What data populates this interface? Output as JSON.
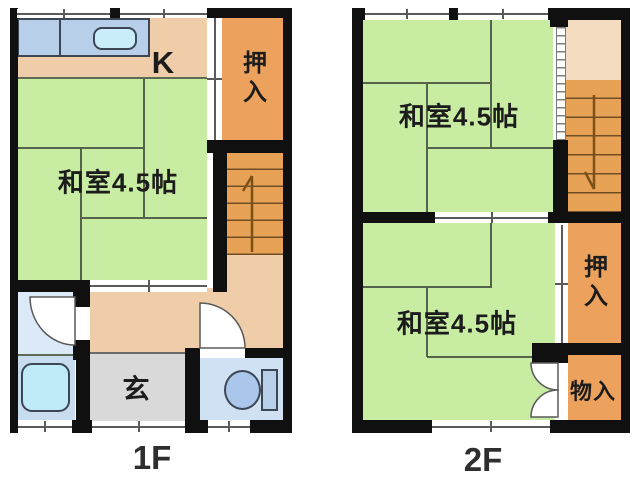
{
  "floor1": {
    "floor_label": "1F",
    "kitchen_label": "K",
    "tatami_room_label": "和室4.5帖",
    "closet_label": "押入",
    "entrance_label": "玄"
  },
  "floor2": {
    "floor_label": "2F",
    "tatami_room_top_label": "和室4.5帖",
    "tatami_room_bottom_label": "和室4.5帖",
    "closet_label": "押入",
    "storage_label": "物入"
  },
  "colors": {
    "wall": "#101010",
    "tatami_green": "#c7eca2",
    "floor_peach": "#f0cda9",
    "stair_landing": "#f4dcc0",
    "closet_orange": "#eca25d",
    "stairs_orange": "#e7a256",
    "genkan_gray": "#d9d9d9",
    "counter_blue": "#b7cfe9",
    "sink_blue": "#c9eefa",
    "washroom_blue": "#dce9f7",
    "bath_blue": "#c8dcf0",
    "tub_blue": "#bfeaf8",
    "toilet_blue": "#cfe1f2",
    "label_text": "#1c1c1c"
  }
}
